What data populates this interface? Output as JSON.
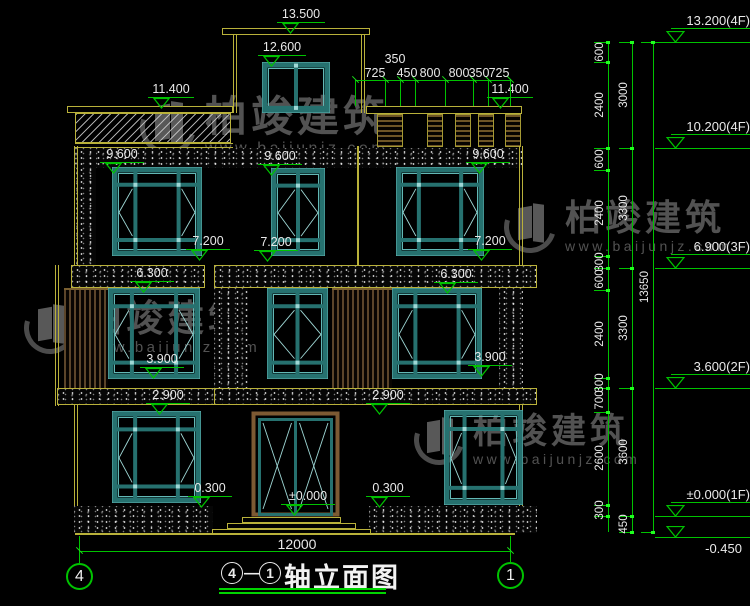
{
  "watermark": {
    "brand": "柏竣建筑",
    "url": "www.baijunjz.com"
  },
  "top_dims": [
    "725",
    "350",
    "450",
    "800",
    "800",
    "350",
    "725"
  ],
  "building_markers": [
    "13.500",
    "12.600",
    "11.400",
    "11.400",
    "9.600",
    "9.600",
    "9.600",
    "7.200",
    "7.200",
    "7.200",
    "6.300",
    "6.300",
    "3.900",
    "3.900",
    "2.900",
    "2.900",
    "0.300",
    "0.300",
    "±0.000"
  ],
  "bottom": {
    "overall_dim": "12000",
    "axis_left": "4",
    "axis_right": "1",
    "title_axis_left": "4",
    "title_axis_right": "1",
    "title_sep": "—",
    "title_text": "轴立面图"
  },
  "right_panel": {
    "levels": [
      "13.200(4F)",
      "10.200(4F)",
      "6.900(3F)",
      "3.600(2F)",
      "±0.000(1F)",
      "-0.450"
    ],
    "dims_inner": [
      "600",
      "2400",
      "600",
      "2400",
      "300",
      "600",
      "2400",
      "300",
      "700",
      "2600",
      "300"
    ],
    "dims_mid": [
      "3000",
      "3300",
      "3300",
      "3600",
      "450"
    ],
    "dim_total": "13650"
  }
}
